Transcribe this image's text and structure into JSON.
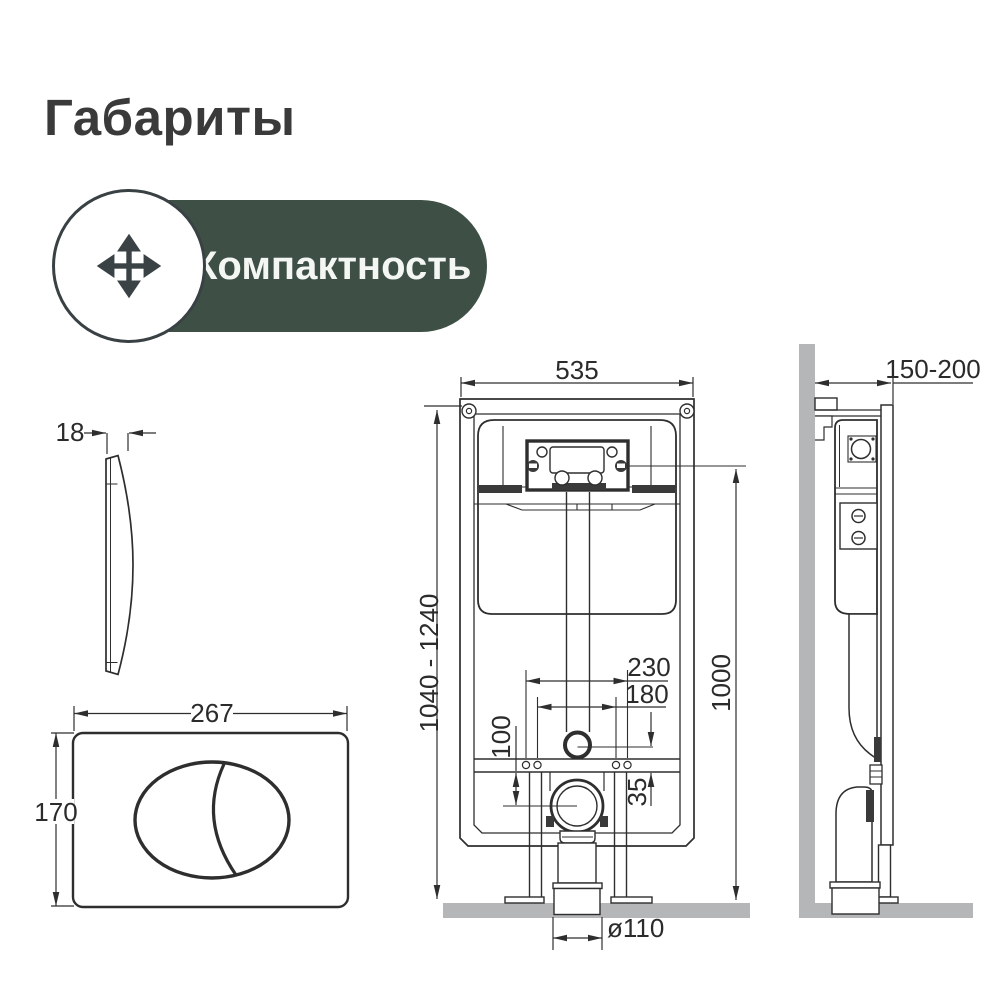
{
  "page": {
    "title": "Габариты"
  },
  "badge": {
    "label": "Компактность",
    "icon": "move-arrows-icon",
    "pill_color": "#3e5045",
    "text_color": "#f4f6f3",
    "icon_color": "#3b4246"
  },
  "drawing": {
    "line_color": "#2e2e2e",
    "surface_color": "#b4b6b8",
    "dimensions": {
      "plate_thickness": "18",
      "plate_width": "267",
      "plate_height": "170",
      "frame_width": "535",
      "frame_height_range": "1040 - 1240",
      "install_height": "1000",
      "fixing_spacing_outer": "230",
      "fixing_spacing_inner": "180",
      "outlet_drop": "100",
      "inlet_offset": "35",
      "drain_diameter": "ø110",
      "frame_depth_range": "150-200"
    }
  }
}
